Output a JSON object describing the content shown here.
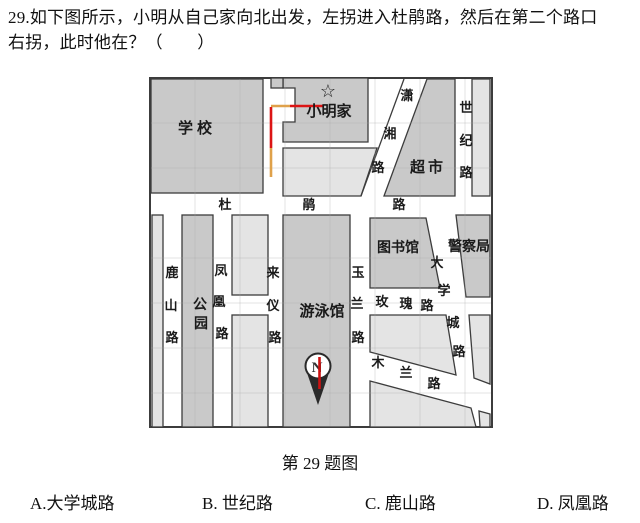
{
  "question": {
    "line1": "29.如下图所示，小明从自己家向北出发，左拐进入杜鹃路，然后在第二个路口",
    "line2": "右拐，此时他在？（　　）"
  },
  "figure": {
    "caption": "第 29 题图"
  },
  "options": [
    "A.大学城路",
    "B. 世纪路",
    "C. 鹿山路",
    "D. 凤凰路"
  ],
  "map": {
    "star": "☆",
    "compass": {
      "north_label": "N"
    },
    "places": {
      "school": "学校",
      "home": "小明家",
      "supermarket": "超市",
      "park": "公园",
      "pool": "游泳馆",
      "library": "图书馆",
      "police": "警察局"
    },
    "roads": {
      "dujuan": "杜鹃路",
      "xiaoxiang": "潇湘路",
      "shiji": "世纪路",
      "lushan": "鹿山路",
      "fenghuang": "凤凰路",
      "laiyi": "来仪路",
      "yulan": "玉兰路",
      "meigui": "玫瑰路",
      "daxuecheng": "大学城路",
      "mulan": "木兰路"
    },
    "colors": {
      "block-medium": "#c9c9c9",
      "block-light": "#e4e4e4",
      "map-border": "#3c3c3c",
      "path-red": "#dc1414",
      "path-orange": "#dfa14a",
      "needle-red": "#cc1111"
    }
  }
}
